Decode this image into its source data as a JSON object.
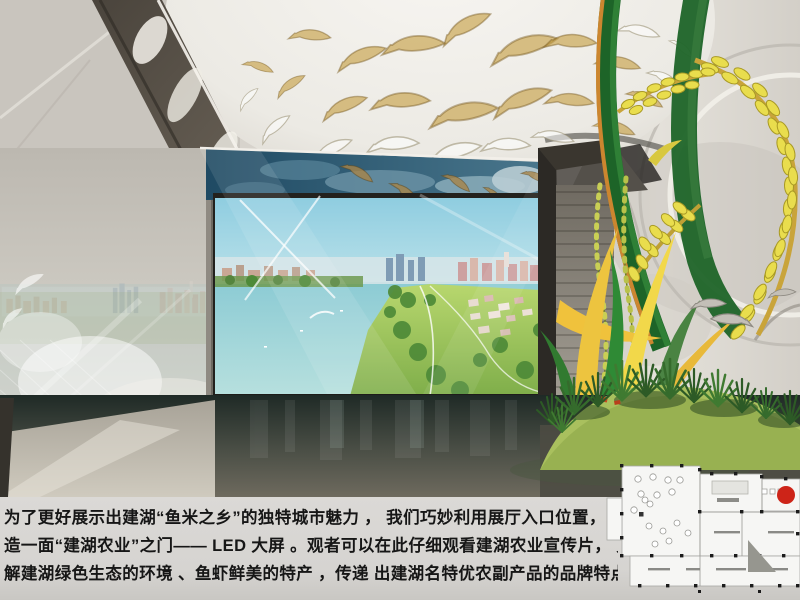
{
  "caption": {
    "lines": [
      "为了更好展示出建湖“鱼米之乡”的独特城市魅力 ， 我们巧妙利用展厅入口位置， 创新打",
      "造一面“建湖农业”之门—— LED 大屏 。观者可以在此仔细观看建湖农业宣传片， 更好了",
      "解建湖绿色生态的环境 、鱼虾鲜美的特产 ，传递  出建湖名特优农副产品的品牌特点。"
    ]
  },
  "floor_plan": {
    "marker_color": "#cd2418"
  },
  "colors": {
    "rice_gold": "#e9dd4d",
    "stem_green": "#1d6428",
    "grass_dark": "#2d5a26",
    "screen_sky_top": "#8fcde0",
    "screen_water": "#8ccbd4",
    "ceiling_band_blue": "#1f4a63",
    "caption_bg": "#d7d5d2",
    "caption_text": "#161616"
  }
}
